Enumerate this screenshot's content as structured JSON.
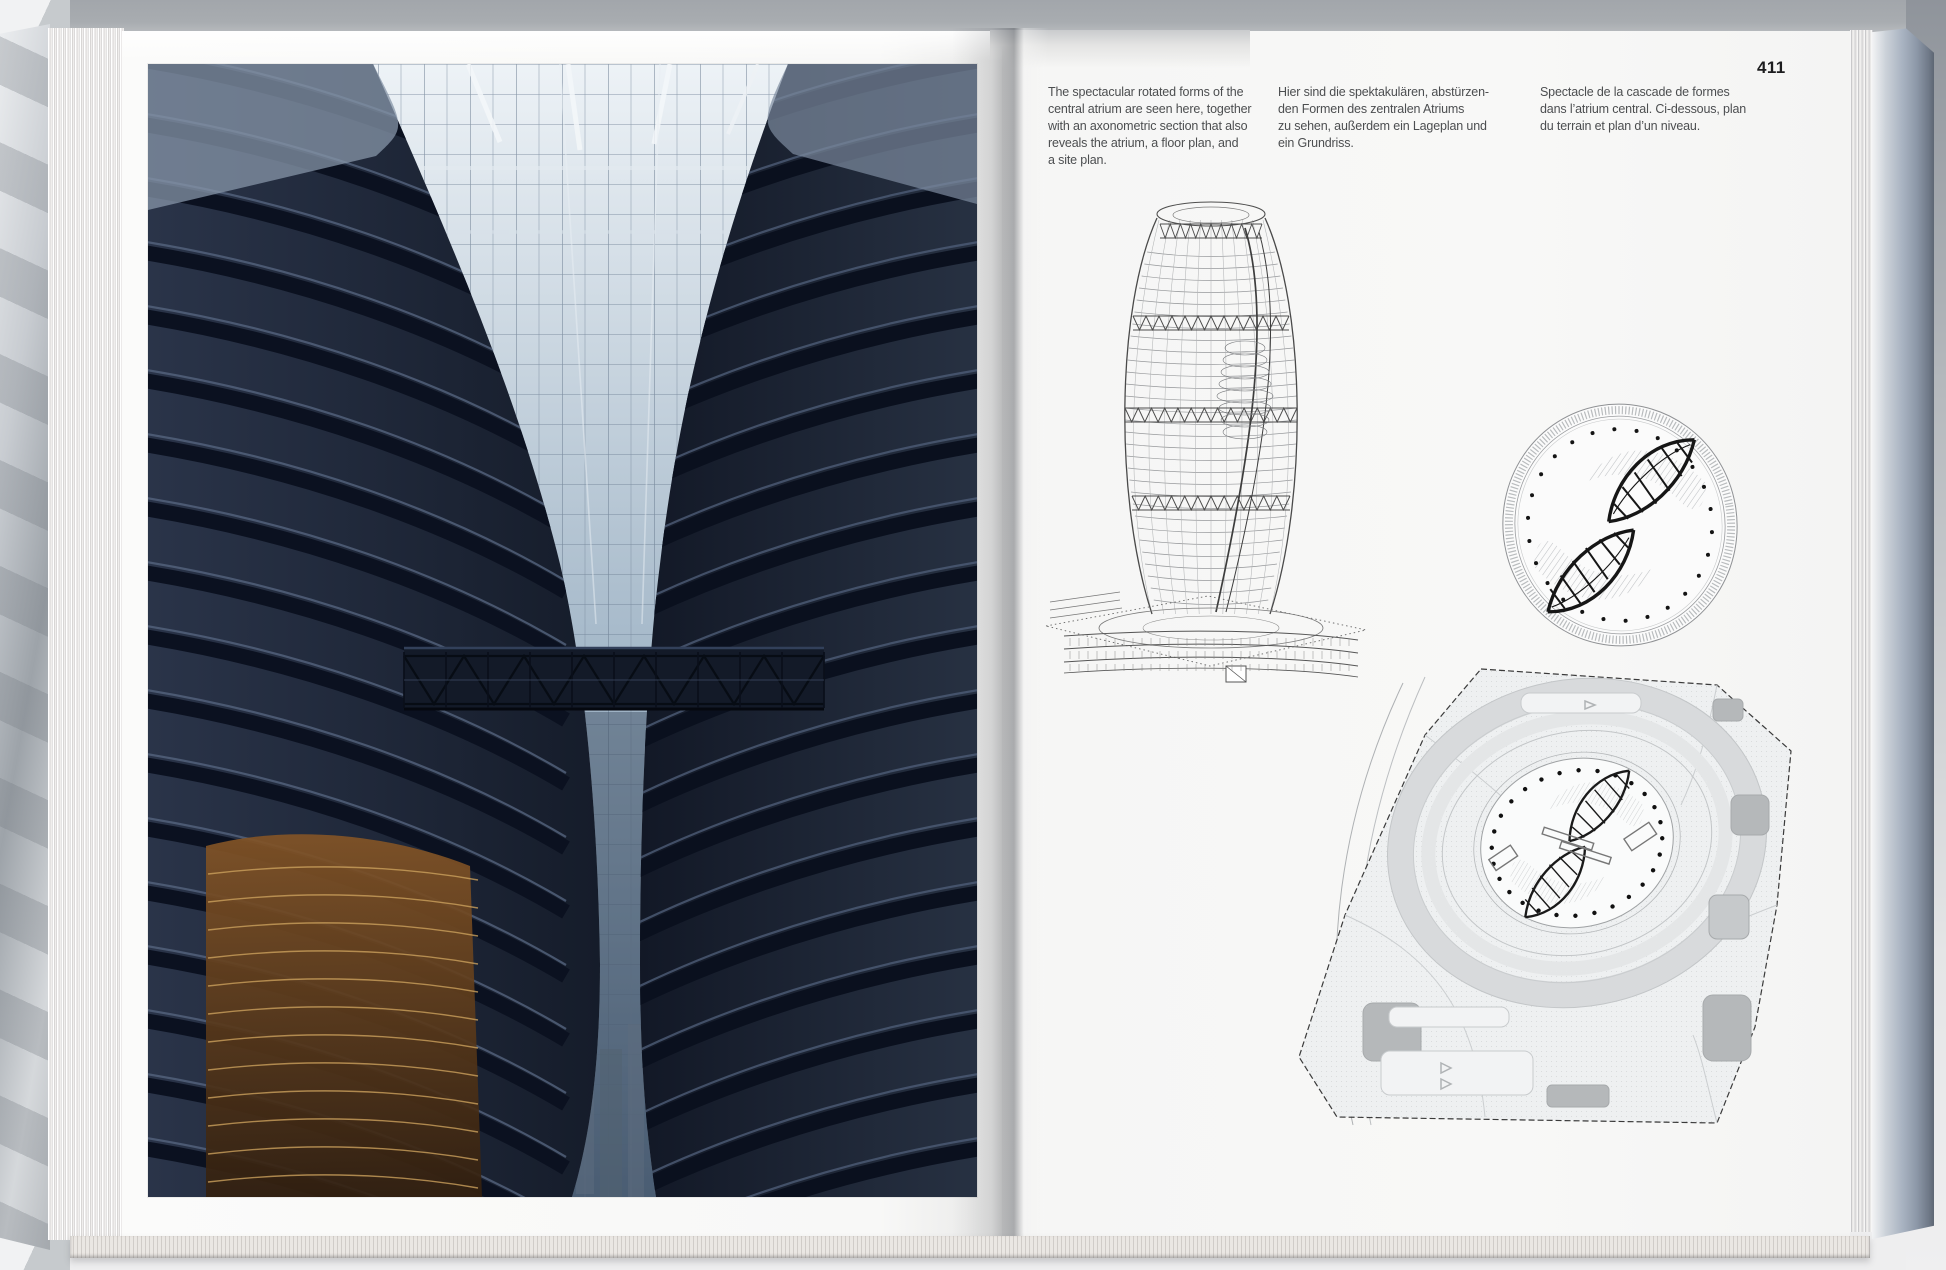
{
  "document": {
    "page_number": "411",
    "captions": {
      "en": "The spectacular rotated forms of the\ncentral atrium are seen here, together\nwith an axonometric section that also\nreveals the atrium, a floor plan, and\na site plan.",
      "de": "Hier sind die spektakulären, abstürzen-\nden Formen des zentralen Atriums\nzu sehen, außerdem ein Lageplan und\nein Grundriss.",
      "fr": "Spectacle de la cascade de formes\ndans l’atrium central. Ci-dessous, plan\ndu terrain et plan d’un niveau."
    }
  },
  "colors": {
    "paper": "#f7f7f6",
    "backdrop-bottom": "#eeeeef",
    "ink": "#4c4e50",
    "page-number-ink": "#1c1c1e",
    "drawing-line": "#5a5a5c",
    "plan-dark": "#161616",
    "site-fill": "#eef0f1",
    "site-blob": "#b5b8ba",
    "photo-steel": "#1d2636",
    "photo-sky": "#ccd6e0",
    "photo-warm": "#7a4e26"
  }
}
